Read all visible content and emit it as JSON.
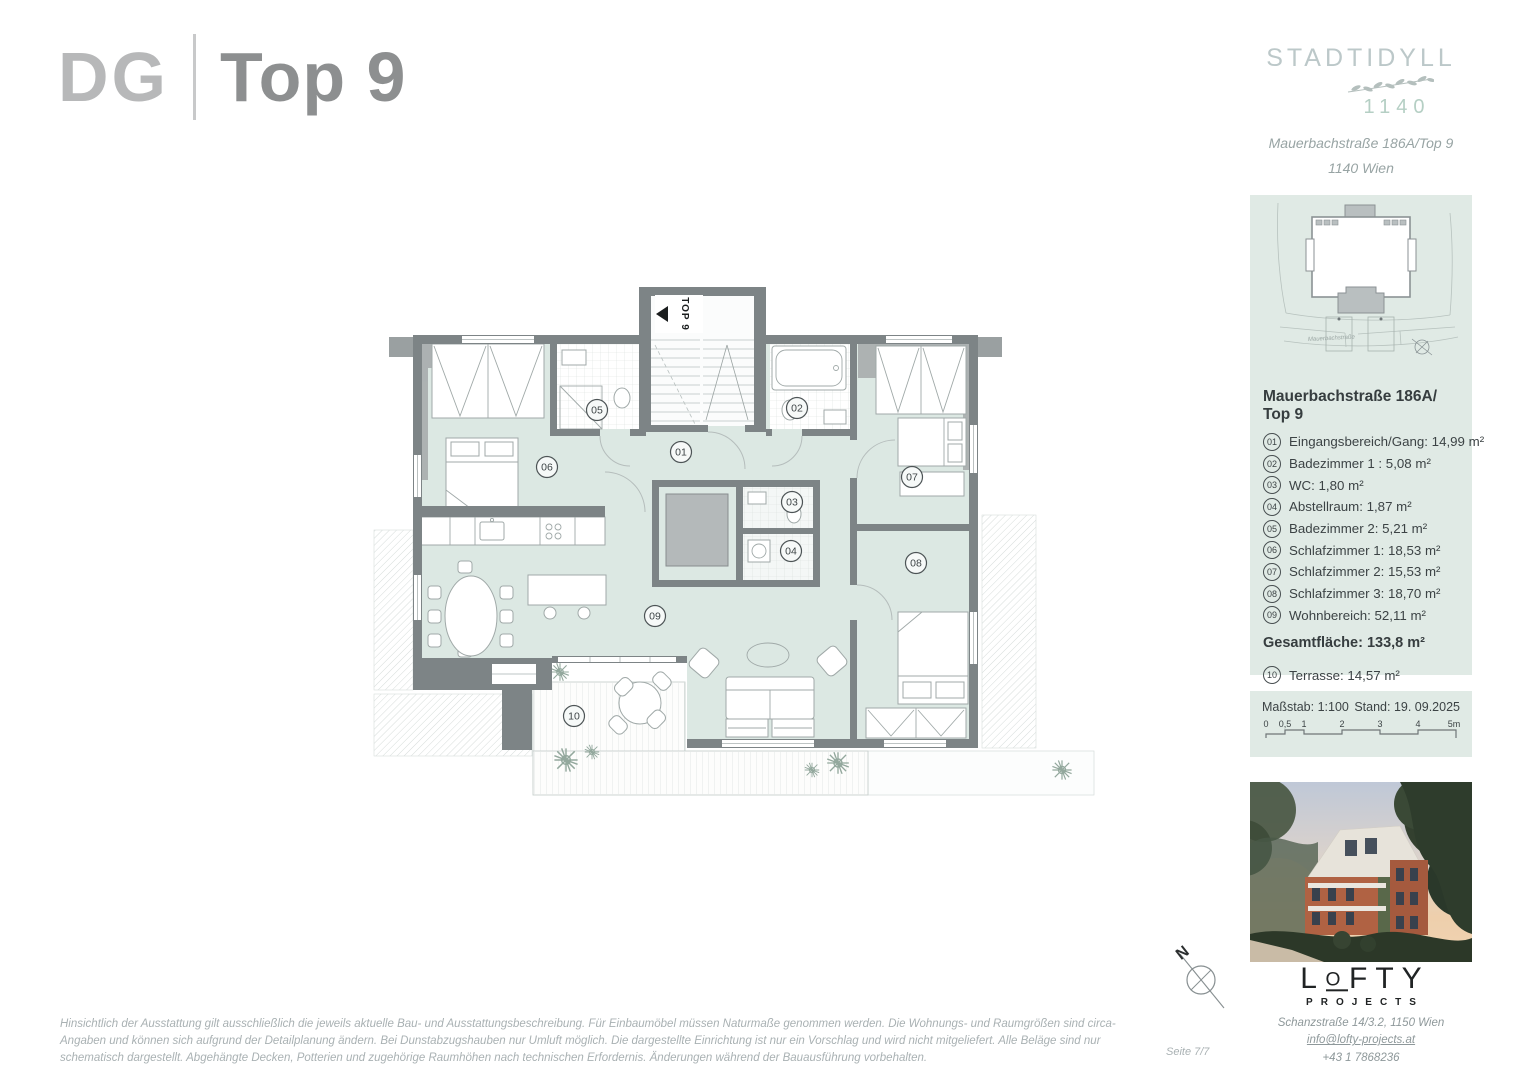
{
  "header": {
    "floor_label": "DG",
    "unit_label": "Top 9"
  },
  "brand": {
    "name": "STADTIDYLL",
    "district": "1140",
    "address_line1": "Mauerbachstraße 186A/Top 9",
    "address_line2": "1140 Wien"
  },
  "site_plan": {
    "street_label": "Mauerbachstraße"
  },
  "room_list": {
    "title": "Mauerbachstraße 186A/ Top 9",
    "items": [
      {
        "num": "01",
        "label": "Eingangsbereich/Gang: 14,99 m²"
      },
      {
        "num": "02",
        "label": "Badezimmer 1 : 5,08 m²"
      },
      {
        "num": "03",
        "label": "WC: 1,80 m²"
      },
      {
        "num": "04",
        "label": "Abstellraum: 1,87 m²"
      },
      {
        "num": "05",
        "label": "Badezimmer 2: 5,21 m²"
      },
      {
        "num": "06",
        "label": "Schlafzimmer 1: 18,53 m²"
      },
      {
        "num": "07",
        "label": "Schlafzimmer 2: 15,53 m²"
      },
      {
        "num": "08",
        "label": "Schlafzimmer 3: 18,70 m²"
      },
      {
        "num": "09",
        "label": "Wohnbereich: 52,11 m²"
      }
    ],
    "total_label": "Gesamtfläche: 133,8 m²",
    "terrace": {
      "num": "10",
      "label": "Terrasse: 14,57 m²"
    }
  },
  "scale_panel": {
    "scale_label": "Maßstab: 1:100",
    "date_label": "Stand: 19. 09.2025",
    "ticks": [
      "0",
      "0,5",
      "1",
      "2",
      "3",
      "4",
      "5m"
    ]
  },
  "plan": {
    "entrance_label": "TOP 9",
    "room_labels": [
      "01",
      "02",
      "03",
      "04",
      "05",
      "06",
      "07",
      "08",
      "09",
      "10"
    ]
  },
  "compass": {
    "label": "N"
  },
  "publisher": {
    "logo_part1": "L",
    "logo_o": "O",
    "logo_part2": "FTY",
    "logo_sub": "PROJECTS",
    "address": "Schanzstraße 14/3.2, 1150 Wien",
    "email": "info@lofty-projects.at",
    "phone": "+43 1 7868236"
  },
  "footer": {
    "disclaimer": "Hinsichtlich der Ausstattung gilt ausschließlich die jeweils aktuelle Bau- und Ausstattungsbeschreibung. Für Einbaumöbel müssen Naturmaße genommen werden. Die Wohnungs- und Raumgrößen sind circa-Angaben und können sich aufgrund der Detailplanung ändern. Bei Dunstabzugshauben nur Umluft möglich. Die dargestellte Einrichtung ist nur ein Vorschlag und wird nicht mitgeliefert. Alle Beläge sind nur schematisch dargestellt. Abgehängte Decken, Potterien und zugehörige Raumhöhen nach technischen Erfordernis. Änderungen während der Bauausführung vorbehalten.",
    "page_label": "Seite 7/7"
  },
  "colors": {
    "mint": "#dce8e3",
    "wall": "#7d8486",
    "brand_teal": "#b5cfc4",
    "text": "#3c4345"
  }
}
